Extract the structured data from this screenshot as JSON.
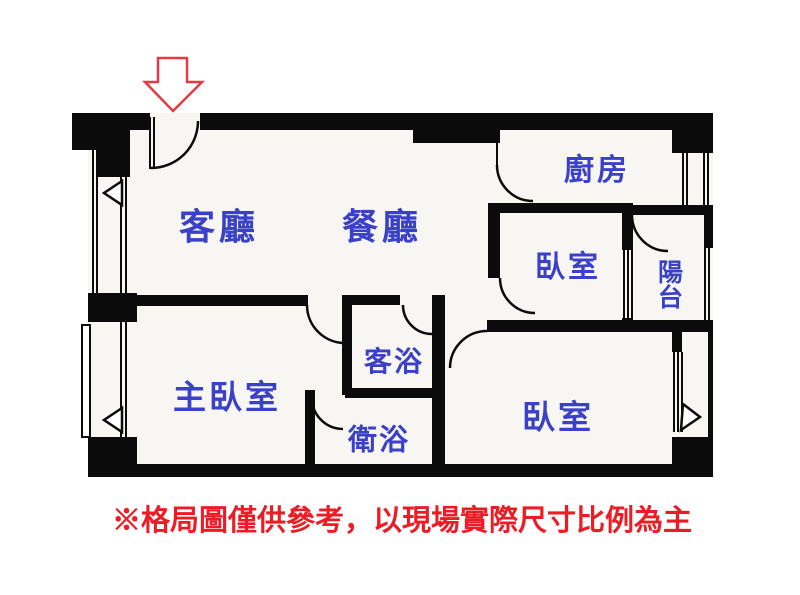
{
  "floorplan": {
    "title": "apartment-floor-plan",
    "rooms": [
      {
        "id": "living-room",
        "name": "客廳"
      },
      {
        "id": "dining-room",
        "name": "餐廳"
      },
      {
        "id": "kitchen",
        "name": "廚房"
      },
      {
        "id": "bedroom-right",
        "name": "臥室"
      },
      {
        "id": "balcony",
        "name": "陽台"
      },
      {
        "id": "guest-bathroom",
        "name": "客浴"
      },
      {
        "id": "bathroom",
        "name": "衛浴"
      },
      {
        "id": "master-bedroom",
        "name": "主臥室"
      },
      {
        "id": "bedroom-bottom",
        "name": "臥室"
      }
    ],
    "entrance": {
      "marker": "red-outline-arrow",
      "direction": "down"
    },
    "note": "※格局圖僅供參考，以現場實際尺寸比例為主",
    "colors": {
      "wall": "#0b0b0b",
      "floor": "#f7f6f3",
      "room_label": "#3a41c8",
      "note_text": "#ed1c24",
      "entrance_arrow": "#e43b42"
    }
  }
}
